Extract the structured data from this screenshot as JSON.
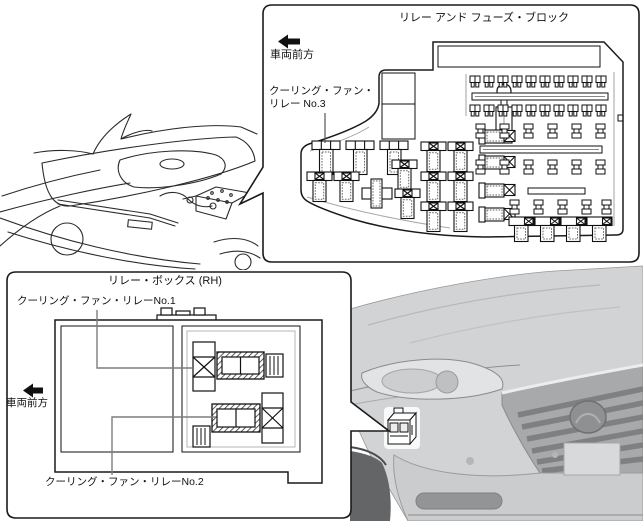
{
  "fuse_block_panel": {
    "title": "リレー アンド フューズ・ブロック",
    "direction_label": "車両前方",
    "relay_label_line1": "クーリング・ファン・",
    "relay_label_line2": "リレー No.3"
  },
  "relay_box_panel": {
    "title": "リレー・ボックス (RH)",
    "direction_label": "車両前方",
    "relay1_label": "クーリング・ファン・リレーNo.1",
    "relay2_label": "クーリング・ファン・リレーNo.2"
  },
  "colors": {
    "outline": "#1a1a1a",
    "leader": "#7d7d7d",
    "car_body": "#d2d3d5",
    "car_shadow": "#aeafb1",
    "car_dark": "#646567"
  }
}
